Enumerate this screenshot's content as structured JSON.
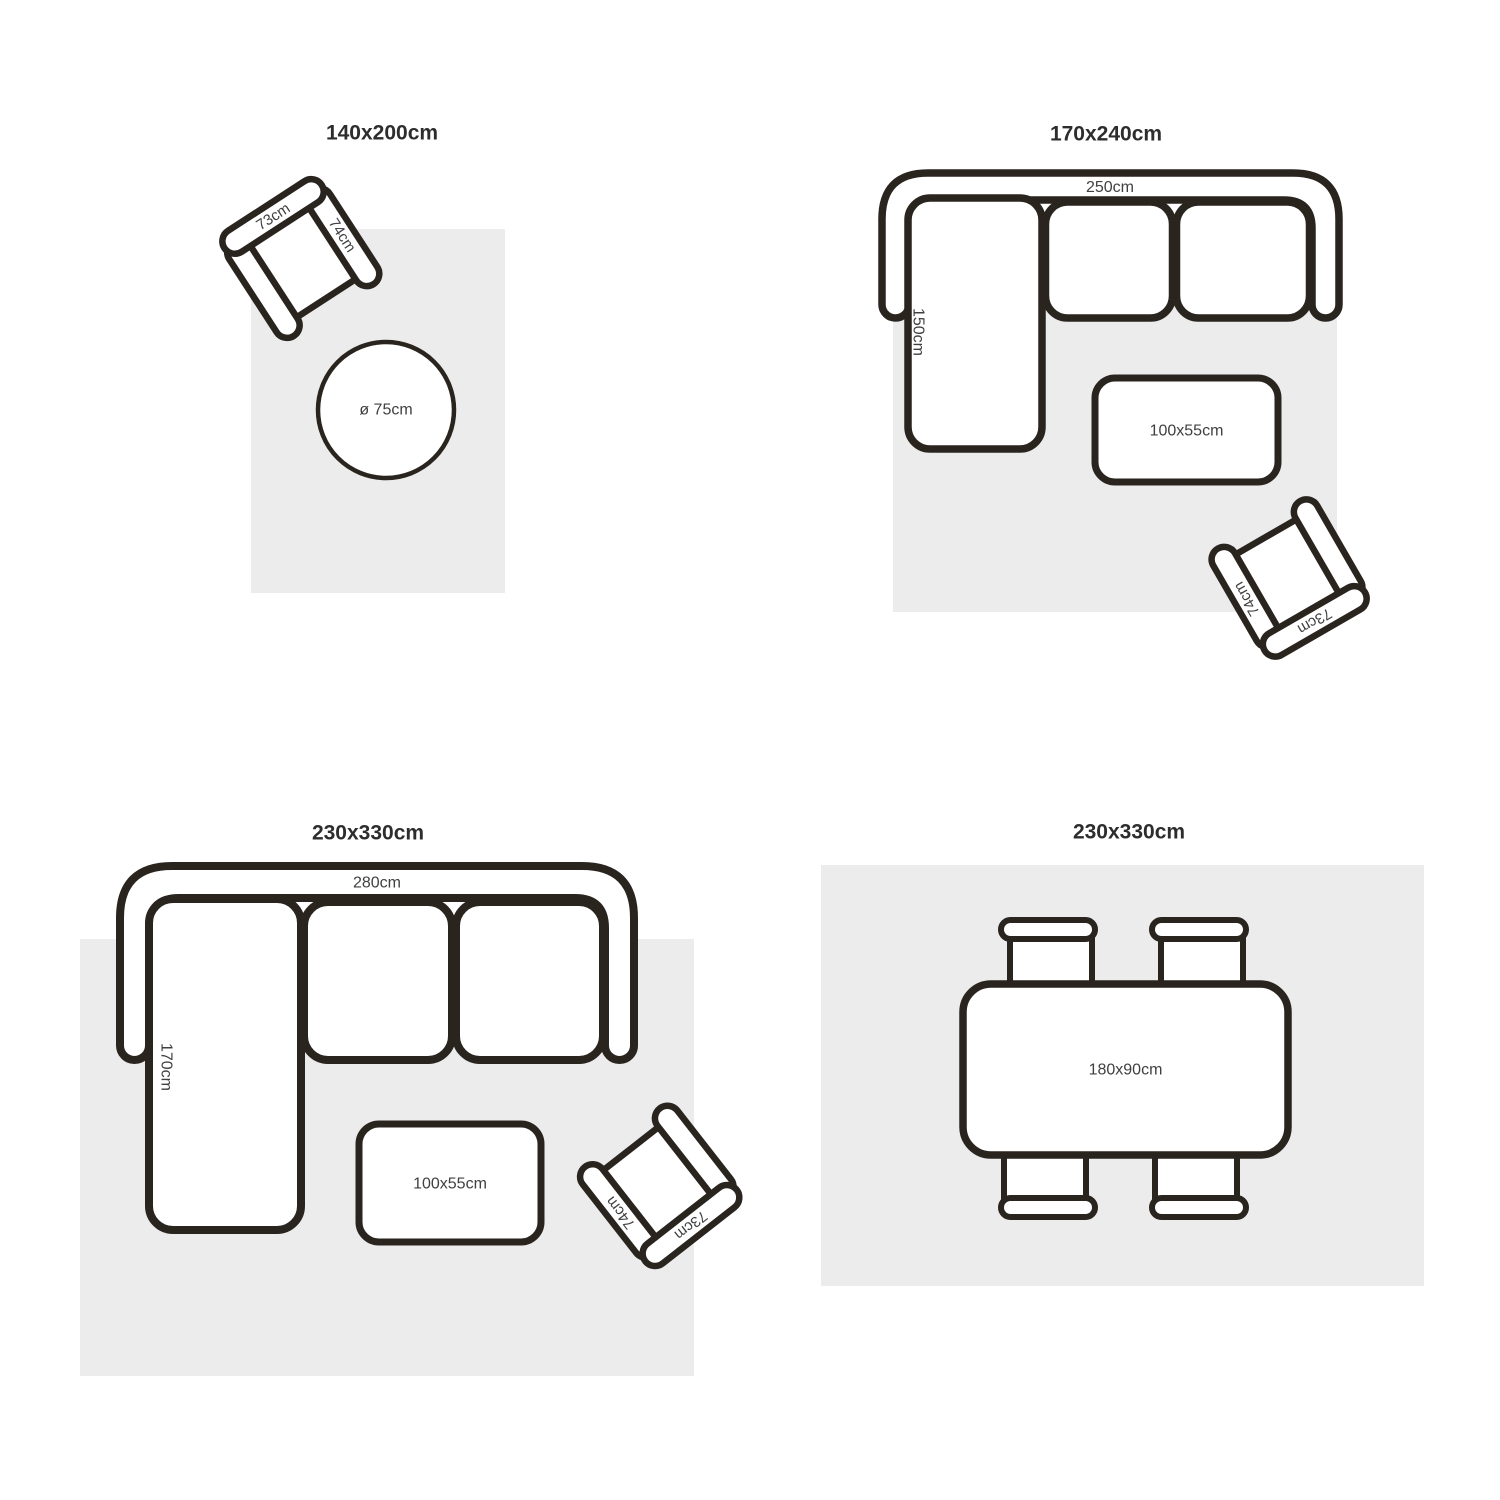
{
  "colors": {
    "background": "#ffffff",
    "outline": "#2a241f",
    "rug_fill": "#ececec",
    "title_text": "#2d2d2d",
    "label_text": "#404040"
  },
  "panels": [
    {
      "id": "rug-140x200",
      "title": "140x200cm",
      "furniture": {
        "armchair": {
          "back_label": "73cm",
          "arm_label": "74cm"
        },
        "round_table": {
          "label": "ø 75cm"
        }
      }
    },
    {
      "id": "rug-170x240",
      "title": "170x240cm",
      "furniture": {
        "sofa": {
          "width_label": "250cm",
          "chaise_label": "150cm"
        },
        "coffee_table": {
          "label": "100x55cm"
        },
        "armchair": {
          "back_label": "73cm",
          "arm_label": "74cm"
        }
      }
    },
    {
      "id": "rug-230x330-living",
      "title": "230x330cm",
      "furniture": {
        "sofa": {
          "width_label": "280cm",
          "chaise_label": "170cm"
        },
        "coffee_table": {
          "label": "100x55cm"
        },
        "armchair": {
          "back_label": "73cm",
          "arm_label": "74cm"
        }
      }
    },
    {
      "id": "rug-230x330-dining",
      "title": "230x330cm",
      "furniture": {
        "dining_table": {
          "label": "180x90cm"
        }
      }
    }
  ]
}
